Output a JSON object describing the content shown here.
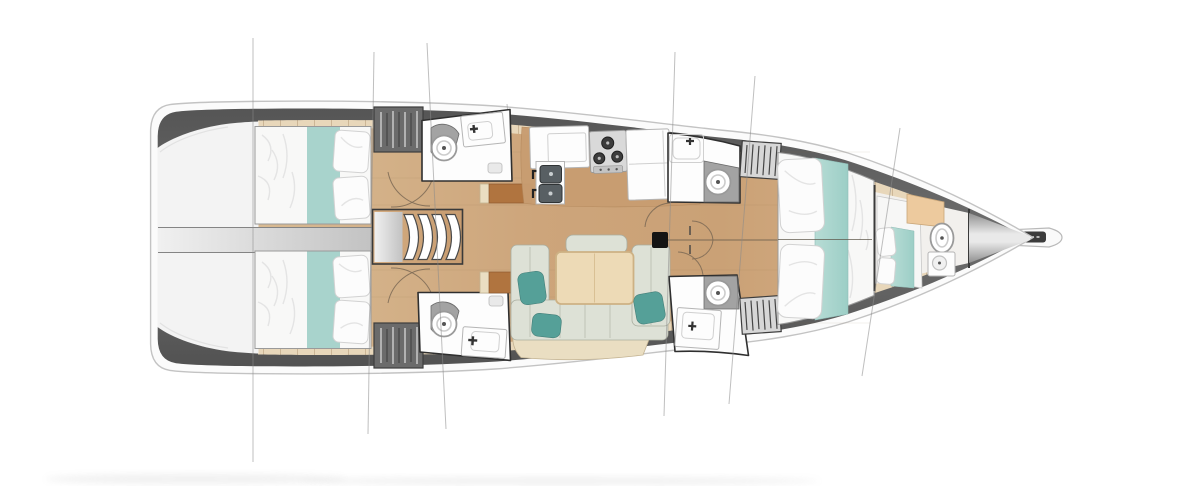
{
  "meta": {
    "title": "Sailing yacht interior layout plan — top-down deck and cabin arrangement",
    "view": "overhead floor plan",
    "orientation": "bow pointing right, stern at left"
  },
  "labels": {
    "plan": "Yacht deck floor plan",
    "hull": "Hull outline with teak side decks",
    "transom_platform": "Stern swim platform",
    "engine_corridor": "Central aft corridor between cabins",
    "companionway": "Companionway steps into saloon",
    "aft_cabin_port": "Aft port cabin with double berth",
    "aft_cabin_starboard": "Aft starboard cabin with double berth",
    "aft_head_port": "Aft port head with toilet and washbasin",
    "aft_head_starboard": "Aft starboard head with toilet and washbasin",
    "galley": "Galley with sinks, stove and cabinets",
    "saloon": "Saloon with U-shaped sofa and table",
    "nav_desk_port": "Port side desk unit",
    "nav_desk_starboard": "Starboard chart desk unit",
    "fwd_head_port": "Forward port head with toilet and washbasin",
    "fwd_head_starboard": "Forward starboard head with toilet and washbasin",
    "mast": "Mast foot",
    "fwd_cabin": "Forward owner cabin with island double berth",
    "forepeak": "Forepeak crew compartment with berth, toilet and basin",
    "bow": "Bow with anchor bowsprit fitting",
    "rigging": "Standing rigging lines crossing the hull"
  },
  "colors": {
    "hull_white": "#fbfbfb",
    "hull_stroke": "#c3c3c3",
    "deck_dark": "#5d5d5d",
    "deck_teak": "#e8d7ba",
    "teak_seam": "#ccb696",
    "floor_wood": "#cfa87d",
    "galley_counter": "#c89d71",
    "room_white": "#fdfdfd",
    "room_outline": "#2f2f2f",
    "bed_white": "#f8f8f7",
    "bed_teal": "#a8d3cc",
    "pillow_teal": "#55a098",
    "sofa_sage": "#dde1d6",
    "bench_beige": "#eadec2",
    "table_tan": "#eddab6",
    "desk_brown": "#b0743f",
    "shelf_peach": "#edca9e",
    "appliance_grey": "#d9d9d9",
    "sink_dark": "#585f63",
    "mast_black": "#141414",
    "rig_line": "#8a8a8a",
    "hatch_dark": "#6b6b6b",
    "hatch_light": "#d7d7d7",
    "corridor_grey": "#d2d2d2",
    "platform_grey": "#f3f3f3",
    "bow_grey": "#979797"
  }
}
